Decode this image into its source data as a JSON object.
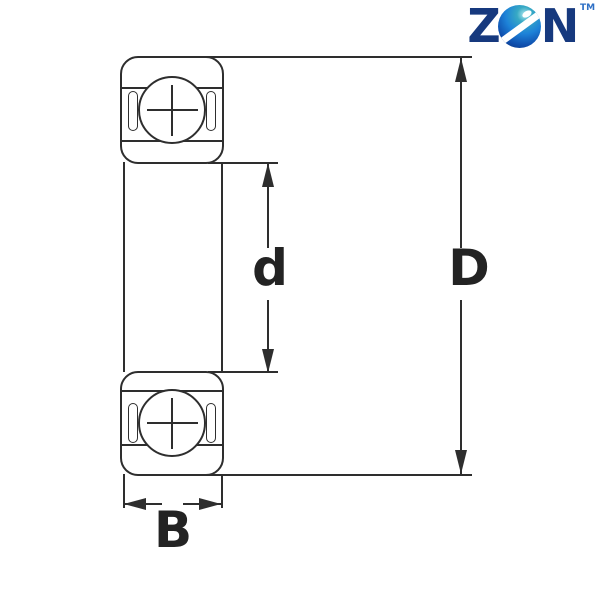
{
  "background": "#ffffff",
  "line_color": "#2e2e2e",
  "logo": {
    "letter_z": "Z",
    "letter_n": "N",
    "trademark": "TM",
    "letter_color": "#16397e",
    "trademark_color": "#2d6fc5",
    "globe_colors": {
      "highlight": "#aee6ee",
      "teal": "#37a9c4",
      "blue": "#1d82d8",
      "deep_blue": "#0f4fae",
      "navy": "#082a6e"
    }
  },
  "diagram": {
    "type": "deep-groove-ball-bearing-cross-section",
    "dimension_labels": {
      "bore_diameter": "d",
      "outer_diameter": "D",
      "width": "B"
    }
  }
}
